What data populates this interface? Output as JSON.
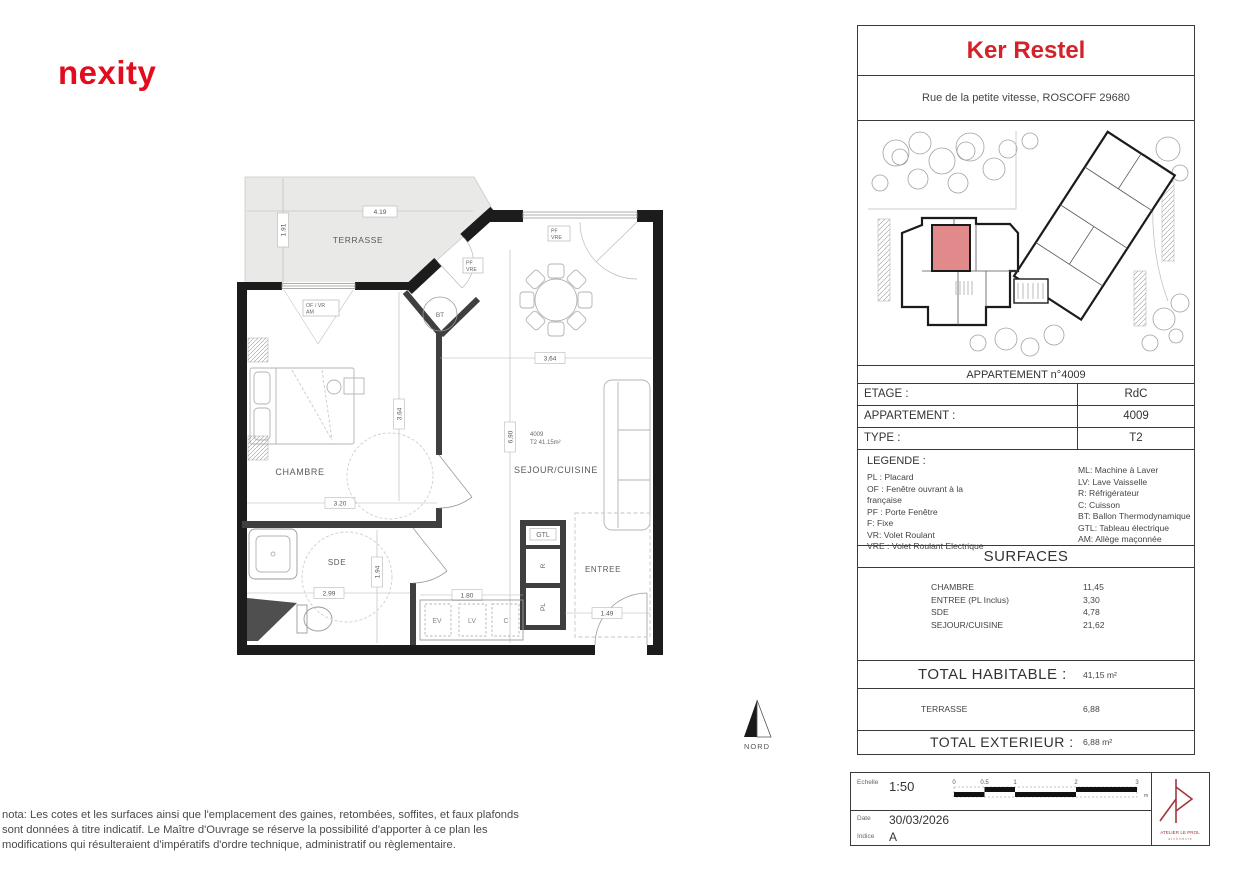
{
  "branding": {
    "logo_text": "nexity",
    "logo_color": "#e30b1e"
  },
  "plan": {
    "rooms": {
      "terrasse": "TERRASSE",
      "chambre": "CHAMBRE",
      "sejour": "SEJOUR/CUISINE",
      "sde": "SDE",
      "entree": "ENTREE"
    },
    "unit": {
      "number": "4009",
      "type_area": "T2 41.15m²"
    },
    "equipment": {
      "bt": "BT",
      "gtl": "GTL",
      "r": "R",
      "pl": "PL",
      "ev": "EV",
      "lv": "LV",
      "c": "C"
    },
    "windows": {
      "chambre_line1": "OF / VR",
      "chambre_line2": "AM",
      "terrace_line1": "PF",
      "terrace_line2": "VRE",
      "sejour_line1": "PF",
      "sejour_line2": "VRE"
    },
    "dims": {
      "terrace_w": "4.19",
      "terrace_h": "1.91",
      "chambre_w": "3.20",
      "chambre_h": "3.64",
      "sejour_w": "3,64",
      "sejour_h": "6,90",
      "sde_w": "2.99",
      "sde_h": "1.94",
      "kitchen_w": "1.80",
      "entree_w": "1.49"
    },
    "north_label": "NORD"
  },
  "panel": {
    "title": "Ker Restel",
    "title_color": "#d32229",
    "address": "Rue de la petite vitesse, ROSCOFF 29680",
    "caption": "APPARTEMENT n°4009",
    "unit_highlight_color": "#e2898c",
    "info_rows": [
      {
        "label": "ETAGE :",
        "value": "RdC"
      },
      {
        "label": "APPARTEMENT :",
        "value": "4009"
      },
      {
        "label": "TYPE :",
        "value": "T2"
      }
    ],
    "legend": {
      "heading": "LEGENDE :",
      "left": [
        "PL : Placard",
        "OF : Fenêtre ouvrant à la française",
        "PF : Porte Fenêtre",
        "F: Fixe",
        "VR: Volet Roulant",
        "VRE : Volet Roulant Electrique"
      ],
      "right": [
        "ML: Machine à Laver",
        "LV: Lave Vaisselle",
        "R: Réfrigérateur",
        "C: Cuisson",
        "BT: Ballon Thermodynamique",
        "GTL: Tableau électrique",
        "AM: Allège maçonnée"
      ]
    },
    "surfaces": {
      "heading": "SURFACES",
      "rooms": [
        {
          "name": "CHAMBRE",
          "area": "11,45"
        },
        {
          "name": "ENTREE (PL Inclus)",
          "area": "3,30"
        },
        {
          "name": "SDE",
          "area": "4,78"
        },
        {
          "name": "SEJOUR/CUISINE",
          "area": "21,62"
        }
      ],
      "total_habitable_label": "TOTAL HABITABLE :",
      "total_habitable_value": "41,15 m²",
      "terrasse_name": "TERRASSE",
      "terrasse_area": "6,88",
      "total_exterior_label": "TOTAL EXTERIEUR :",
      "total_exterior_value": "6,88 m²"
    }
  },
  "title_block": {
    "scale_label": "Echelle",
    "scale_value": "1:50",
    "ticks": [
      "0",
      "0.5",
      "1",
      "2",
      "3"
    ],
    "unit": "m",
    "date_label": "Date",
    "date_value": "30/03/2026",
    "index_label": "Indice",
    "index_value": "A",
    "architect_name": "ATELIER LE PROL",
    "architect_sub": "a r c h i t e c t e",
    "architect_color": "#a5343c"
  },
  "nota": "nota: Les cotes et les surfaces ainsi que l'emplacement des gaines, retombées, soffites, et faux plafonds sont données à titre indicatif. Le Maître d'Ouvrage se réserve la possibilité d'apporter à ce plan les modifications qui résulteraient d'impératifs d'ordre technique, administratif ou règlementaire."
}
